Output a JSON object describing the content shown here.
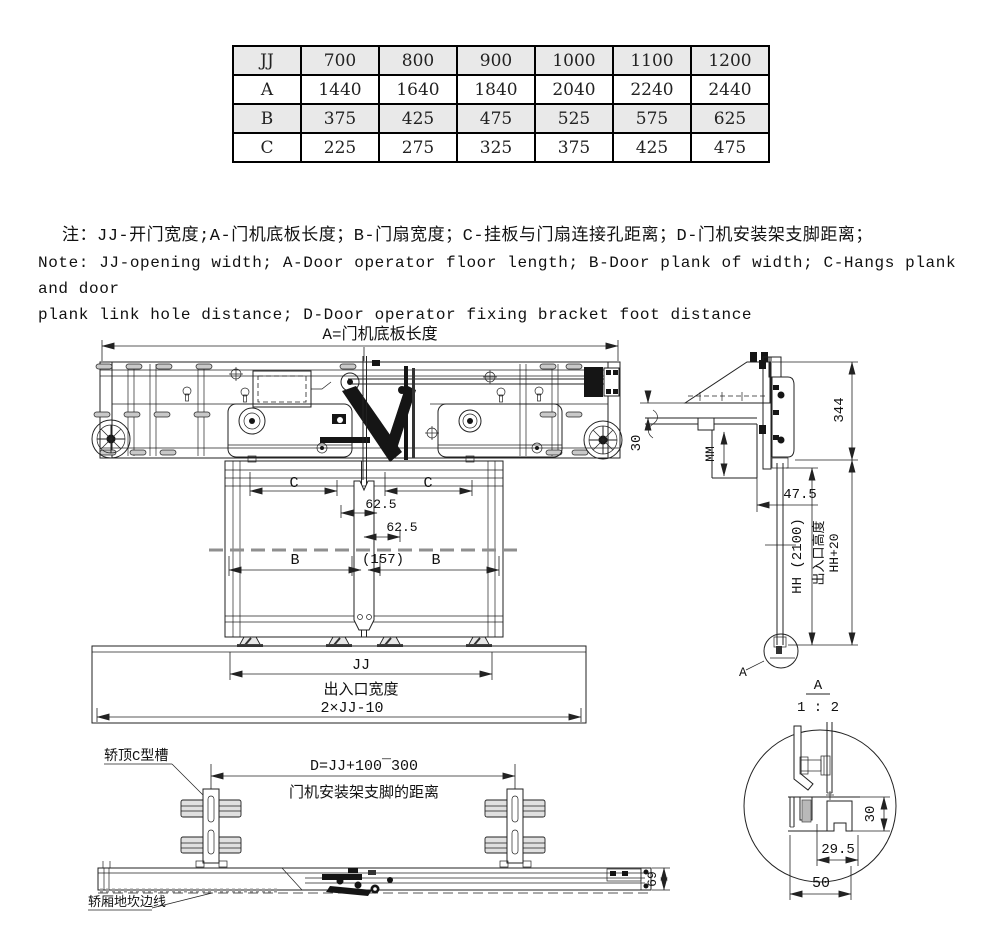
{
  "table": {
    "rows": [
      {
        "label": "JJ",
        "values": [
          "700",
          "800",
          "900",
          "1000",
          "1100",
          "1200"
        ]
      },
      {
        "label": "A",
        "values": [
          "1440",
          "1640",
          "1840",
          "2040",
          "2240",
          "2440"
        ]
      },
      {
        "label": "B",
        "values": [
          "375",
          "425",
          "475",
          "525",
          "575",
          "625"
        ]
      },
      {
        "label": "C",
        "values": [
          "225",
          "275",
          "325",
          "375",
          "425",
          "475"
        ]
      }
    ]
  },
  "notes": {
    "line_cn": "注：JJ-开门宽度;A-门机底板长度；B-门扇宽度；C-挂板与门扇连接孔距离；D-门机安装架支脚距离；",
    "line_en_1": "Note: JJ-opening width; A-Door operator floor length; B-Door plank of width; C-Hangs plank and door",
    "line_en_2": "plank link hole distance; D-Door operator fixing bracket foot distance"
  },
  "front_view": {
    "dim_a_label": "A=门机底板长度",
    "dim_c_left": "C",
    "dim_c_right": "C",
    "dim_62_5_upper": "62.5",
    "dim_62_5_lower": "62.5",
    "dim_b_left": "B",
    "dim_center_gap": "(157)",
    "dim_b_right": "B",
    "dim_jj": "JJ",
    "entrance_width_label": "出入口宽度",
    "dim_total": "2×JJ-10"
  },
  "side_view": {
    "dim_344": "344",
    "dim_30": "30",
    "dim_mm": "MM",
    "dim_47_5": "47.5",
    "dim_hh": "HH (2100)",
    "entrance_height_label": "出入口高度",
    "dim_hh20": "HH+20",
    "detail_label": "A",
    "detail_scale_name": "A",
    "detail_scale": "1 : 2"
  },
  "plan_view": {
    "c_channel_label": "轿顶C型槽",
    "dim_d": "D=JJ+100¯300",
    "bracket_distance_label": "门机安装架支脚的距离",
    "sill_edge_label": "轿厢地坎边线",
    "dim_69": "69"
  },
  "detail_view": {
    "dim_30": "30",
    "dim_29_5": "29.5",
    "dim_50": "50"
  }
}
